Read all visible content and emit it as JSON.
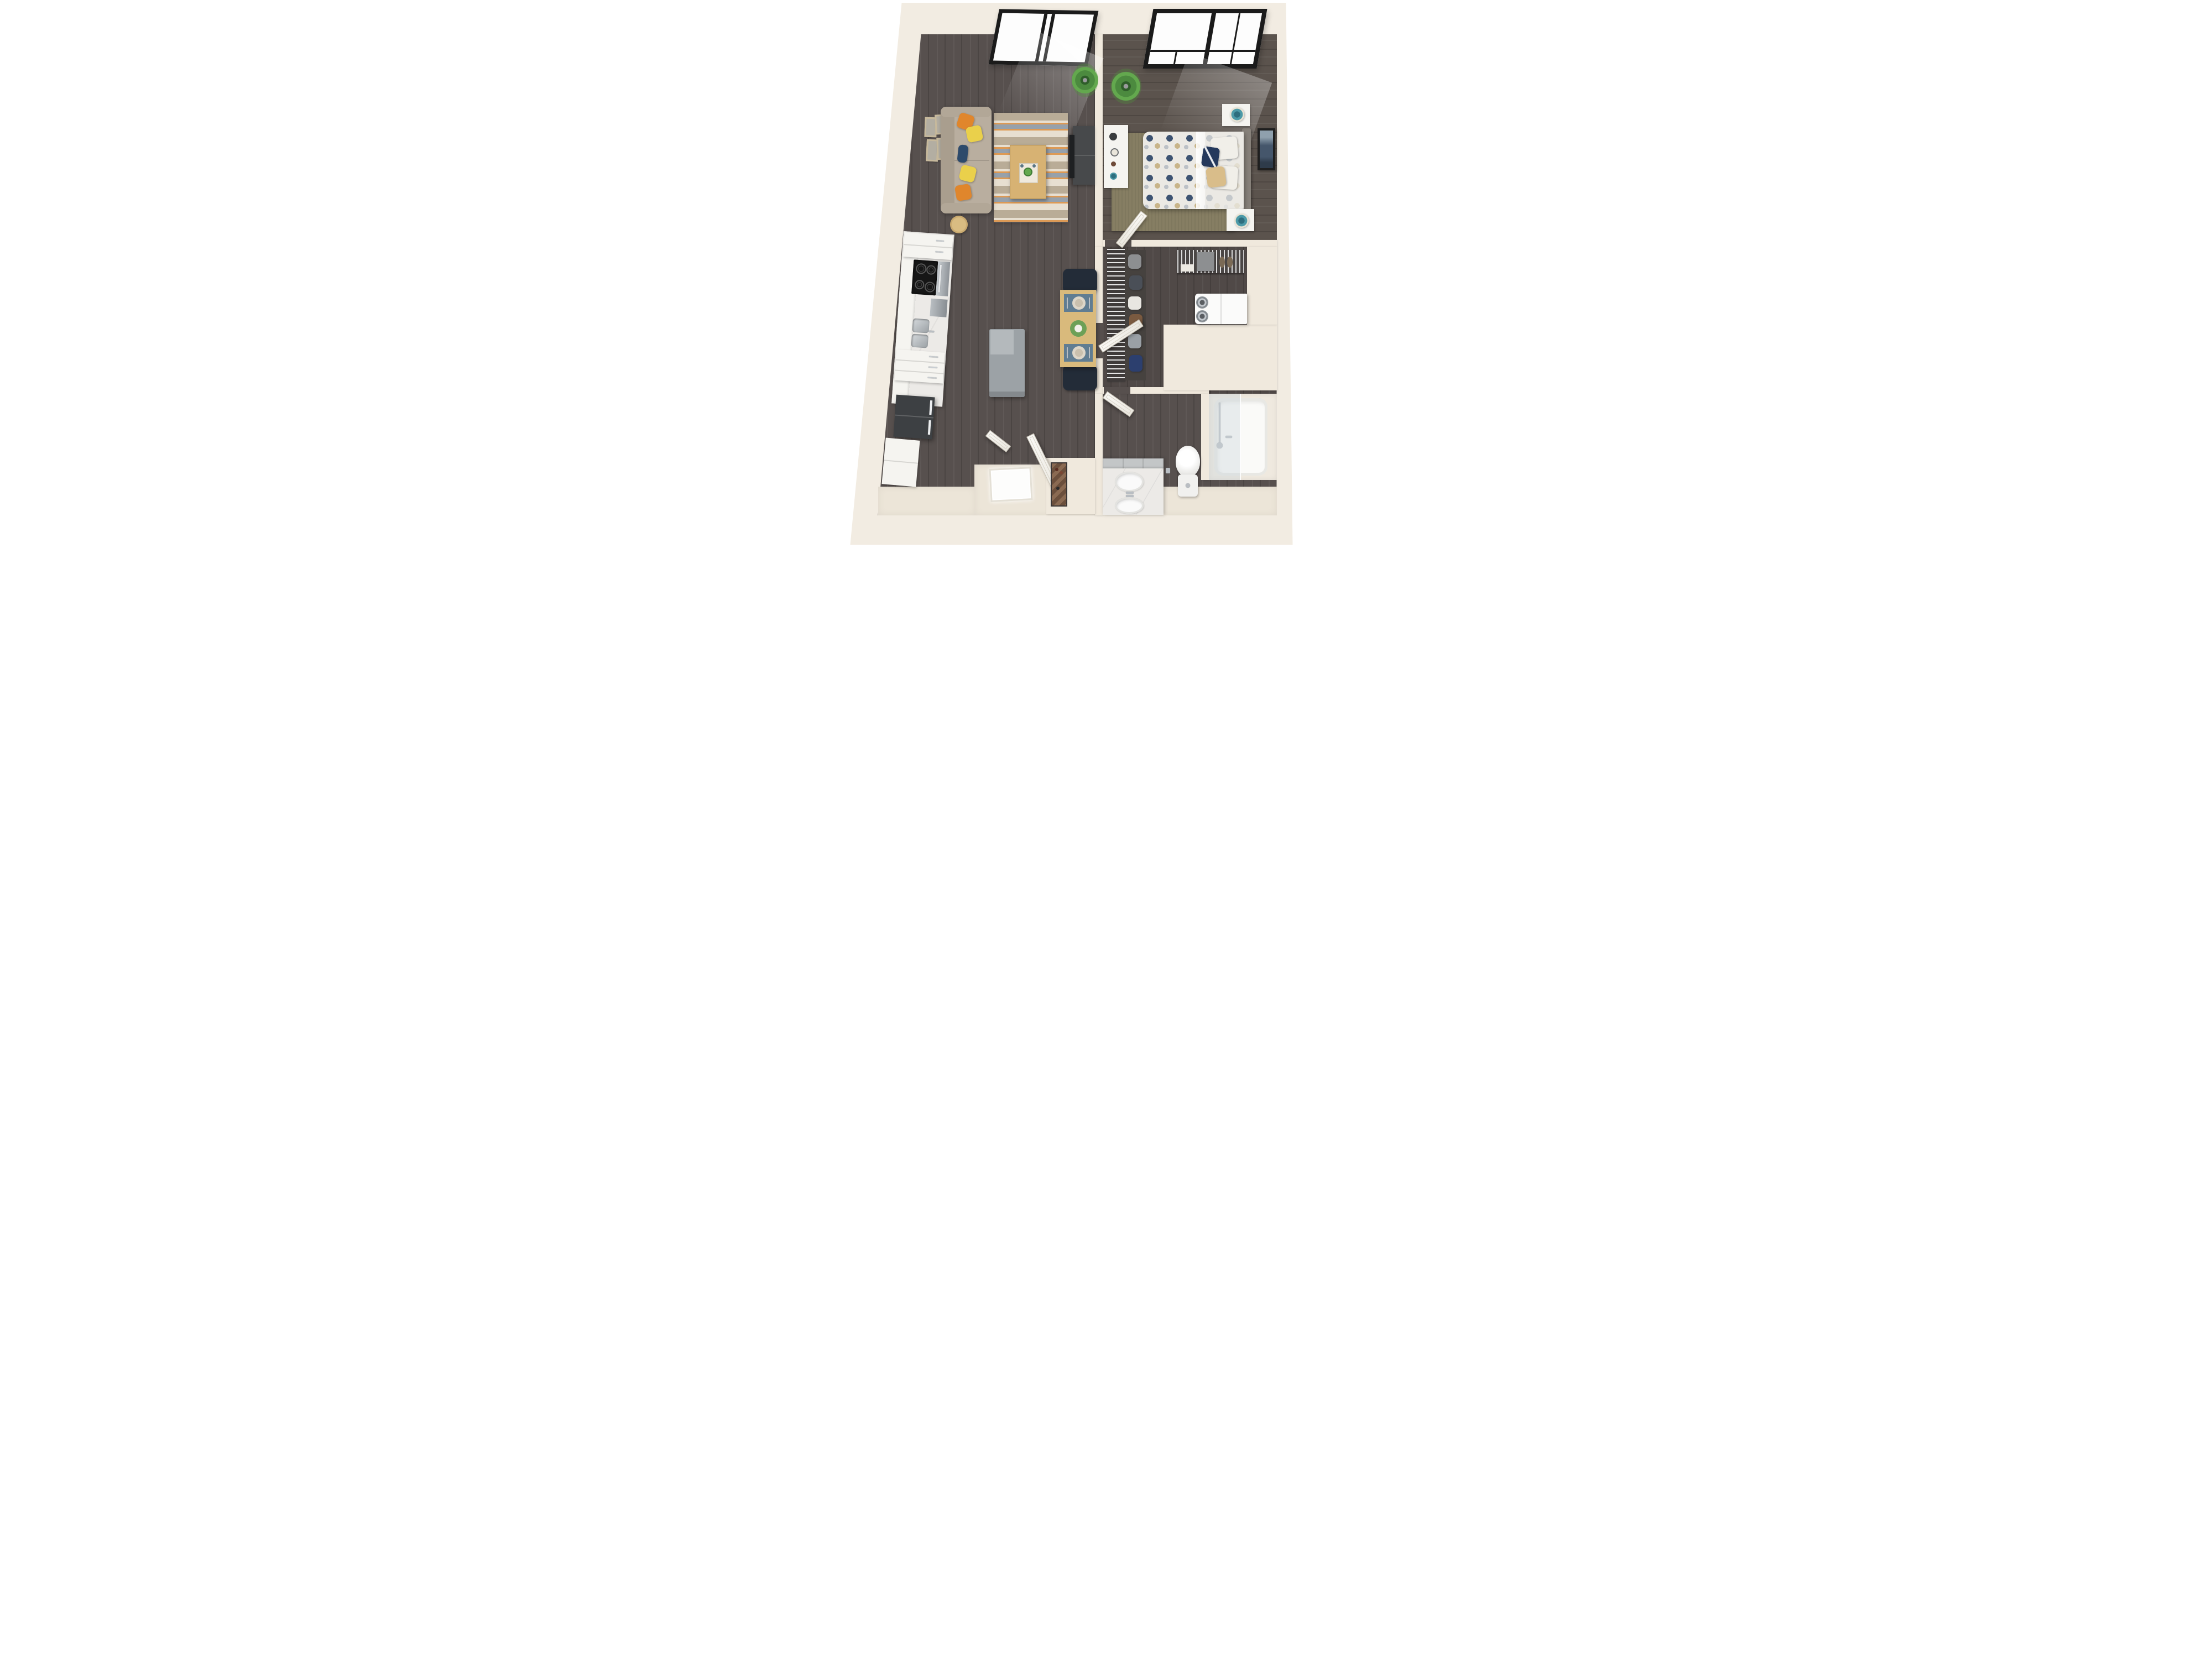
{
  "scene": {
    "title": "One-bedroom apartment 3D floor plan render, top-down view",
    "background_color": "#ffffff",
    "image_type": "3d-floorplan-render",
    "visible_text": ""
  },
  "palette": {
    "wall_cream": "#f2ece2",
    "wall_inner": "#f0e9dd",
    "floor_wood_dark": "#57504e",
    "floor_wood_bedroom": "#5b534d",
    "entry_floor_cream": "#ece5d8",
    "window_frame_black": "#1b1b1b",
    "sofa_beige": "#b9ae9f",
    "pillow_orange": "#e0862c",
    "pillow_yellow": "#ead04b",
    "pillow_navy": "#2d4a6b",
    "rug_cream": "#e7dfd1",
    "rug_tan": "#b9ac97",
    "rug_orange": "#dd9a55",
    "rug_slate": "#97a1ab",
    "coffee_table_wood": "#d7b273",
    "dining_table_wood": "#d9ba7c",
    "chair_navy_black": "#232c38",
    "placemat_blue": "#607d92",
    "marble_counter": "#eceae7",
    "stainless_steel": "#a7acb0",
    "fridge_dark_gray": "#3d4043",
    "cooktop_black": "#161616",
    "duvet_white": "#ebe9e4",
    "duvet_dot_navy": "#3d5372",
    "duvet_dot_tan": "#c2ab79",
    "headboard_gray": "#87817a",
    "bedroom_rug_olive": "#867e63",
    "lamp_teal": "#4d9aa8",
    "plant_green": "#4c8a3f",
    "door_white": "#f7f5f1",
    "fixture_chrome": "#b9bec3",
    "porcelain_white": "#f6f6f4",
    "island_gray": "#9ca2a6",
    "entry_shelf_brown": "#8a6a52",
    "wall_art_slate": "#45566b"
  },
  "rooms": [
    {
      "id": "living-room",
      "label": "Living room"
    },
    {
      "id": "kitchen",
      "label": "Kitchen"
    },
    {
      "id": "dining-area",
      "label": "Dining area"
    },
    {
      "id": "bedroom",
      "label": "Bedroom"
    },
    {
      "id": "walk-in-closet",
      "label": "Walk-in closet"
    },
    {
      "id": "laundry-nook",
      "label": "Laundry nook"
    },
    {
      "id": "bathroom",
      "label": "Bathroom"
    },
    {
      "id": "entry",
      "label": "Entry"
    }
  ],
  "furniture": {
    "living_room": [
      "roof window",
      "sofa with five throw pillows",
      "four wall frames",
      "striped area rug",
      "wood coffee table with tray plant",
      "round side table",
      "tv console with tv",
      "potted plant"
    ],
    "kitchen": [
      "upper white cabinets",
      "electric cooktop with oven",
      "dishwasher",
      "double stainless sink",
      "drawer cabinets",
      "dark refrigerator",
      "white pantry cabinet",
      "gray island"
    ],
    "dining_area": [
      "wood dining table",
      "two navy chairs",
      "two place settings",
      "flower centerpiece"
    ],
    "bedroom": [
      "skylight window",
      "double bed with polka-dot duvet",
      "gray headboard",
      "two white nightstands with teal lamps",
      "white dresser with decor",
      "olive area rug",
      "potted plant",
      "framed wall art",
      "open door"
    ],
    "walk_in_closet": [
      "wire shelving tower",
      "hanging clothes",
      "wire baskets with shoes and box",
      "open door"
    ],
    "laundry_nook": [
      "stacked washer dryer pair"
    ],
    "bathroom": [
      "marble vanity with two sinks",
      "toilet",
      "bathtub with glass screen and chrome fixtures",
      "open door"
    ],
    "entry": [
      "entry threshold",
      "two open white doors",
      "zigzag shelf unit with bottles"
    ]
  },
  "counts": {
    "windows": 2,
    "open_doors": 6,
    "throw_pillows": 5,
    "wall_frames_living": 4,
    "dining_seats": 2,
    "bathroom_sinks": 2,
    "washer_dryer_doors": 2
  }
}
